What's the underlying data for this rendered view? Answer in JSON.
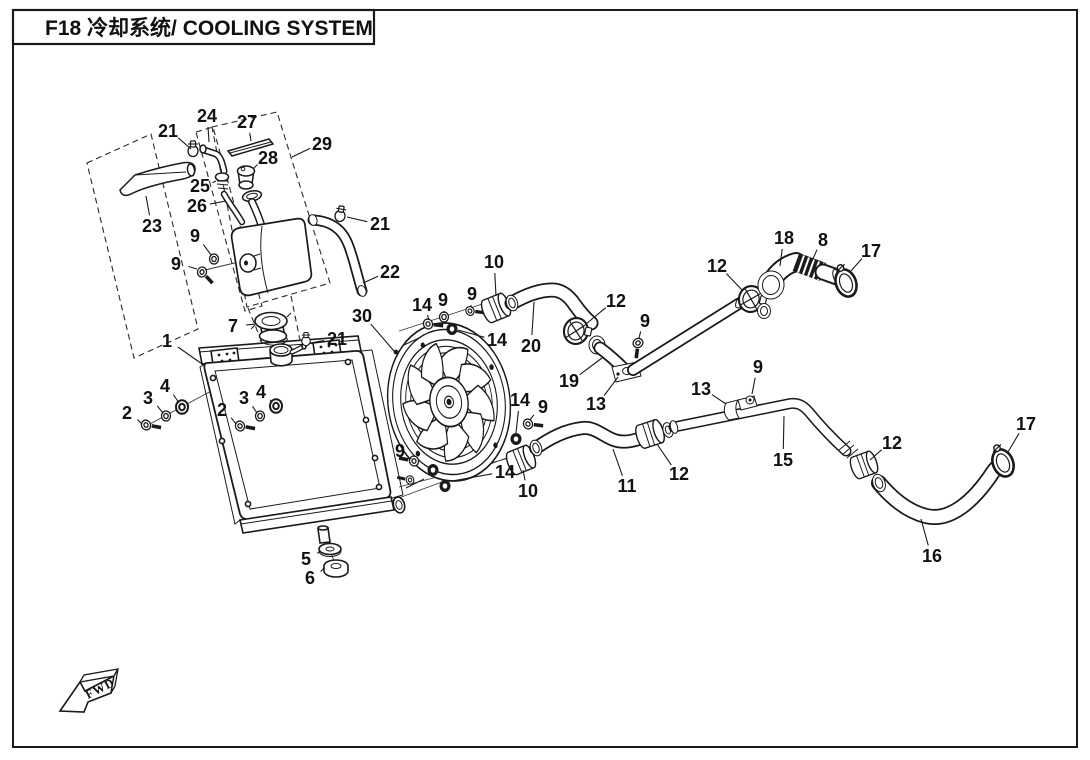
{
  "title": "F18 冷却系统/ COOLING SYSTEM",
  "fwd_label": "FWD",
  "diagram": {
    "type": "exploded-parts-diagram",
    "subject": "Cooling system",
    "model_code": "F18",
    "part_numbers_shown": [
      "1",
      "2",
      "3",
      "4",
      "5",
      "6",
      "7",
      "8",
      "9",
      "10",
      "11",
      "12",
      "13",
      "14",
      "15",
      "16",
      "17",
      "18",
      "19",
      "20",
      "21",
      "22",
      "23",
      "24",
      "25",
      "26",
      "27",
      "28",
      "29",
      "30"
    ]
  },
  "colors": {
    "ink": "#1a1a1a",
    "background": "#ffffff"
  },
  "callouts": [
    {
      "n": "21",
      "lx": 168,
      "ly": 131,
      "tx": 191,
      "ty": 149
    },
    {
      "n": "24",
      "lx": 207,
      "ly": 116,
      "tx": 209,
      "ty": 142
    },
    {
      "n": "27",
      "lx": 247,
      "ly": 122,
      "tx": 251,
      "ty": 141
    },
    {
      "n": "29",
      "lx": 322,
      "ly": 144,
      "tx": 292,
      "ty": 157
    },
    {
      "n": "28",
      "lx": 268,
      "ly": 158,
      "tx": 253,
      "ty": 169
    },
    {
      "n": "25",
      "lx": 200,
      "ly": 186,
      "tx": 216,
      "ty": 181
    },
    {
      "n": "26",
      "lx": 197,
      "ly": 206,
      "tx": 226,
      "ty": 201
    },
    {
      "n": "23",
      "lx": 152,
      "ly": 226,
      "tx": 146,
      "ty": 196
    },
    {
      "n": "9",
      "lx": 195,
      "ly": 236,
      "tx": 211,
      "ty": 255
    },
    {
      "n": "9",
      "lx": 176,
      "ly": 264,
      "tx": 197,
      "ty": 269
    },
    {
      "n": "21",
      "lx": 380,
      "ly": 224,
      "tx": 347,
      "ty": 217
    },
    {
      "n": "22",
      "lx": 390,
      "ly": 272,
      "tx": 363,
      "ty": 283
    },
    {
      "n": "7",
      "lx": 233,
      "ly": 326,
      "tx": 256,
      "ty": 324
    },
    {
      "n": "1",
      "lx": 167,
      "ly": 341,
      "tx": 205,
      "ty": 366
    },
    {
      "n": "21",
      "lx": 337,
      "ly": 339,
      "tx": 310,
      "ty": 343
    },
    {
      "n": "30",
      "lx": 362,
      "ly": 316,
      "tx": 394,
      "ty": 351
    },
    {
      "n": "2",
      "lx": 127,
      "ly": 413,
      "tx": 142,
      "ty": 424
    },
    {
      "n": "3",
      "lx": 148,
      "ly": 398,
      "tx": 163,
      "ty": 413
    },
    {
      "n": "4",
      "lx": 165,
      "ly": 386,
      "tx": 179,
      "ty": 403
    },
    {
      "n": "2",
      "lx": 222,
      "ly": 410,
      "tx": 236,
      "ty": 424
    },
    {
      "n": "3",
      "lx": 244,
      "ly": 398,
      "tx": 257,
      "ty": 413
    },
    {
      "n": "4",
      "lx": 261,
      "ly": 392,
      "tx": 272,
      "ty": 403
    },
    {
      "n": "5",
      "lx": 306,
      "ly": 559,
      "tx": 320,
      "ty": 551
    },
    {
      "n": "6",
      "lx": 310,
      "ly": 578,
      "tx": 324,
      "ty": 568
    },
    {
      "n": "10",
      "lx": 494,
      "ly": 262,
      "tx": 496,
      "ty": 296
    },
    {
      "n": "14",
      "lx": 422,
      "ly": 305,
      "tx": 429,
      "ty": 320
    },
    {
      "n": "9",
      "lx": 443,
      "ly": 300,
      "tx": 444,
      "ty": 313
    },
    {
      "n": "9",
      "lx": 472,
      "ly": 294,
      "tx": 471,
      "ty": 307
    },
    {
      "n": "14",
      "lx": 497,
      "ly": 340,
      "tx": 458,
      "ty": 330
    },
    {
      "n": "20",
      "lx": 531,
      "ly": 346,
      "tx": 534,
      "ty": 302
    },
    {
      "n": "12",
      "lx": 616,
      "ly": 301,
      "tx": 586,
      "ty": 324
    },
    {
      "n": "18",
      "lx": 784,
      "ly": 238,
      "tx": 780,
      "ty": 266
    },
    {
      "n": "8",
      "lx": 823,
      "ly": 240,
      "tx": 812,
      "ty": 261
    },
    {
      "n": "17",
      "lx": 871,
      "ly": 251,
      "tx": 850,
      "ty": 272
    },
    {
      "n": "12",
      "lx": 717,
      "ly": 266,
      "tx": 743,
      "ty": 291
    },
    {
      "n": "9",
      "lx": 645,
      "ly": 321,
      "tx": 639,
      "ty": 338
    },
    {
      "n": "19",
      "lx": 569,
      "ly": 381,
      "tx": 602,
      "ty": 358
    },
    {
      "n": "13",
      "lx": 596,
      "ly": 404,
      "tx": 618,
      "ty": 377
    },
    {
      "n": "13",
      "lx": 701,
      "ly": 389,
      "tx": 726,
      "ty": 404
    },
    {
      "n": "9",
      "lx": 758,
      "ly": 367,
      "tx": 752,
      "ty": 394
    },
    {
      "n": "14",
      "lx": 520,
      "ly": 400,
      "tx": 516,
      "ty": 433
    },
    {
      "n": "9",
      "lx": 543,
      "ly": 407,
      "tx": 530,
      "ty": 420
    },
    {
      "n": "9",
      "lx": 400,
      "ly": 451,
      "tx": 411,
      "ty": 459
    },
    {
      "n": "14",
      "lx": 505,
      "ly": 472,
      "tx": 452,
      "ty": 481
    },
    {
      "n": "10",
      "lx": 528,
      "ly": 491,
      "tx": 523,
      "ty": 470
    },
    {
      "n": "11",
      "lx": 627,
      "ly": 486,
      "tx": 613,
      "ty": 449
    },
    {
      "n": "12",
      "lx": 679,
      "ly": 474,
      "tx": 657,
      "ty": 444
    },
    {
      "n": "15",
      "lx": 783,
      "ly": 460,
      "tx": 784,
      "ty": 416
    },
    {
      "n": "12",
      "lx": 892,
      "ly": 443,
      "tx": 870,
      "ty": 460
    },
    {
      "n": "17",
      "lx": 1026,
      "ly": 424,
      "tx": 1008,
      "ty": 452
    },
    {
      "n": "16",
      "lx": 932,
      "ly": 556,
      "tx": 921,
      "ty": 519
    }
  ]
}
